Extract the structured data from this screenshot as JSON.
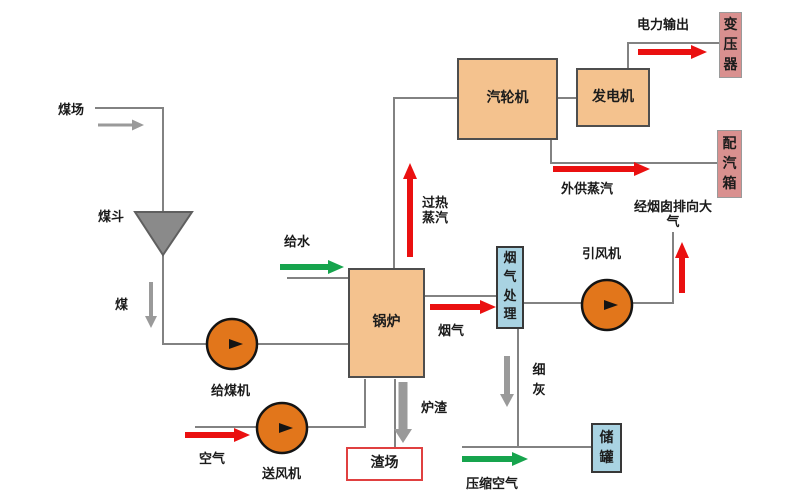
{
  "colors": {
    "line_gray": "#828282",
    "arrow_red": "#ea1010",
    "arrow_green": "#16a44d",
    "arrow_gray": "#9a9a9a",
    "box_orange": "#f4c28e",
    "box_pink": "#d9908f",
    "box_blue": "#a9d3e2",
    "pump_orange": "#e2761b",
    "funnel_gray": "#8a8a8a",
    "slag_border_red": "#e04040",
    "text_black": "#1a1a1a"
  },
  "diagram": {
    "boxes": {
      "boiler": "锅炉",
      "turbine": "汽轮机",
      "generator": "发电机",
      "transformer": "变压器",
      "steam_distribution_box": "配汽箱",
      "flue_gas_treatment": "烟气处理",
      "storage_tank": "储罐",
      "slag_yard": "渣场"
    },
    "labels": {
      "coal_yard": "煤场",
      "coal_hopper": "煤斗",
      "coal": "煤",
      "coal_feeder": "给煤机",
      "air": "空气",
      "forced_draft_fan": "送风机",
      "feed_water": "给水",
      "superheated_steam": "过热蒸汽",
      "power_output": "电力输出",
      "external_steam_supply": "外供蒸汽",
      "to_atmosphere_via_chimney": "经烟囱排向大气",
      "flue_gas": "烟气",
      "induced_draft_fan": "引风机",
      "fine_ash": "细灰",
      "furnace_slag": "炉渣",
      "compressed_air": "压缩空气"
    }
  }
}
